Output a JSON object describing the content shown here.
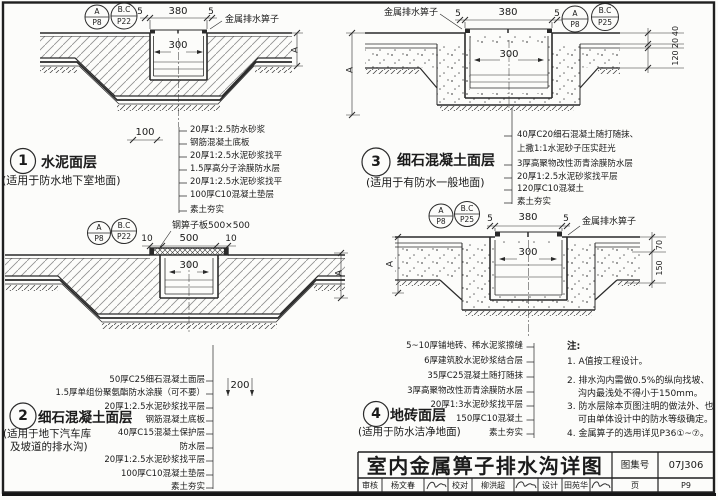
{
  "palette": {
    "line": "#2a2a2a",
    "paper": "#fcfcfa",
    "text": "#1b1b1b"
  },
  "details": [
    {
      "num": "1",
      "title": "水泥面层",
      "subtitle_lines": [
        "(适用于防水地下室地面)"
      ],
      "refs": [
        {
          "top": "A",
          "bottom": "P8"
        },
        {
          "top": "B.C",
          "bottom": "P22"
        }
      ],
      "grate_label": "金属排水箅子",
      "dims": {
        "gap_left": "5",
        "width": "380",
        "gap_right": "5",
        "inner": "300",
        "depth": "A",
        "extra": "100"
      },
      "layers": [
        "20厚1:2.5防水砂浆",
        "钢筋混凝土底板",
        "20厚1:2.5水泥砂浆找平",
        "1.5厚高分子涂膜防水层",
        "20厚1:2.5水泥砂浆找平",
        "100厚C10混凝土垫层",
        "素土夯实"
      ]
    },
    {
      "num": "2",
      "title": "细石混凝土面层",
      "subtitle_lines": [
        "(适用于地下汽车库",
        "及坡道的排水沟)"
      ],
      "refs": [
        {
          "top": "A",
          "bottom": "P8"
        },
        {
          "top": "B.C",
          "bottom": "P22"
        }
      ],
      "grate_label": "钢箅子板500×500",
      "dims": {
        "gap_left": "10",
        "width": "500",
        "gap_right": "10",
        "inner": "300",
        "depth": "A",
        "extra": "200"
      },
      "layers": [
        "50厚C25细石混凝土面层",
        "1.5厚单组份聚氨酯防水涂膜（可不要）",
        "20厚1:2.5水泥砂浆找平层",
        "钢筋混凝土底板",
        "40厚C15混凝土保护层",
        "防水层",
        "20厚1:2.5水泥砂浆找平层",
        "100厚C10混凝土垫层",
        "素土夯实"
      ]
    },
    {
      "num": "3",
      "title": "细石混凝土面层",
      "subtitle_lines": [
        "(适用于有防水一般地面)"
      ],
      "refs": [
        {
          "top": "A",
          "bottom": "P8"
        },
        {
          "top": "B.C",
          "bottom": "P25"
        }
      ],
      "grate_label": "金属排水箅子",
      "dims": {
        "gap_left": "5",
        "width": "380",
        "gap_right": "5",
        "inner": "300",
        "depth": "A",
        "right_chain": [
          "40",
          "20",
          "120"
        ]
      },
      "layers": [
        "40厚C20细石混凝土随打随抹、",
        "上撒1:1水泥砂子压实赶光",
        "3厚高聚物改性沥青涂膜防水层",
        "20厚1:2.5水泥砂浆找平层",
        "120厚C10混凝土",
        "素土夯实"
      ]
    },
    {
      "num": "4",
      "title": "地砖面层",
      "subtitle_lines": [
        "(适用于防水洁净地面)"
      ],
      "refs": [
        {
          "top": "A",
          "bottom": "P8"
        },
        {
          "top": "B.C",
          "bottom": "P25"
        }
      ],
      "grate_label": "金属排水箅子",
      "dims": {
        "gap_left": "5",
        "width": "380",
        "gap_right": "5",
        "inner": "300",
        "depth": "A",
        "right_chain": [
          "70",
          "150"
        ]
      },
      "layers": [
        "5~10厚铺地砖、稀水泥浆擦缝",
        "6厚建筑胶水泥砂浆结合层",
        "35厚C25混凝土随打随抹",
        "3厚高聚物改性沥青涂膜防水层",
        "20厚1:3水泥砂浆找平层",
        "150厚C10混凝土",
        "素土夯实"
      ]
    }
  ],
  "notes": {
    "heading": "注:",
    "lines": [
      "1. A值按工程设计。",
      "2. 排水沟内需做0.5%的纵向找坡、",
      "沟内最浅处不得小于150mm。",
      "3. 防水层除本页图注明的做法外、也",
      "可由单体设计中的防水等级确定。",
      "4. 金属箅子的选用详见P36①~⑦。"
    ]
  },
  "title_block": {
    "title": "室内金属箅子排水沟详图",
    "atlas_label": "图集号",
    "atlas_no": "07J306",
    "page_label": "页",
    "page_no": "P9",
    "signatures": [
      {
        "label": "审核",
        "name": "杨文春"
      },
      {
        "label": "校对",
        "name": "柳洪超"
      },
      {
        "label": "设计",
        "name": "田苑华"
      }
    ]
  }
}
